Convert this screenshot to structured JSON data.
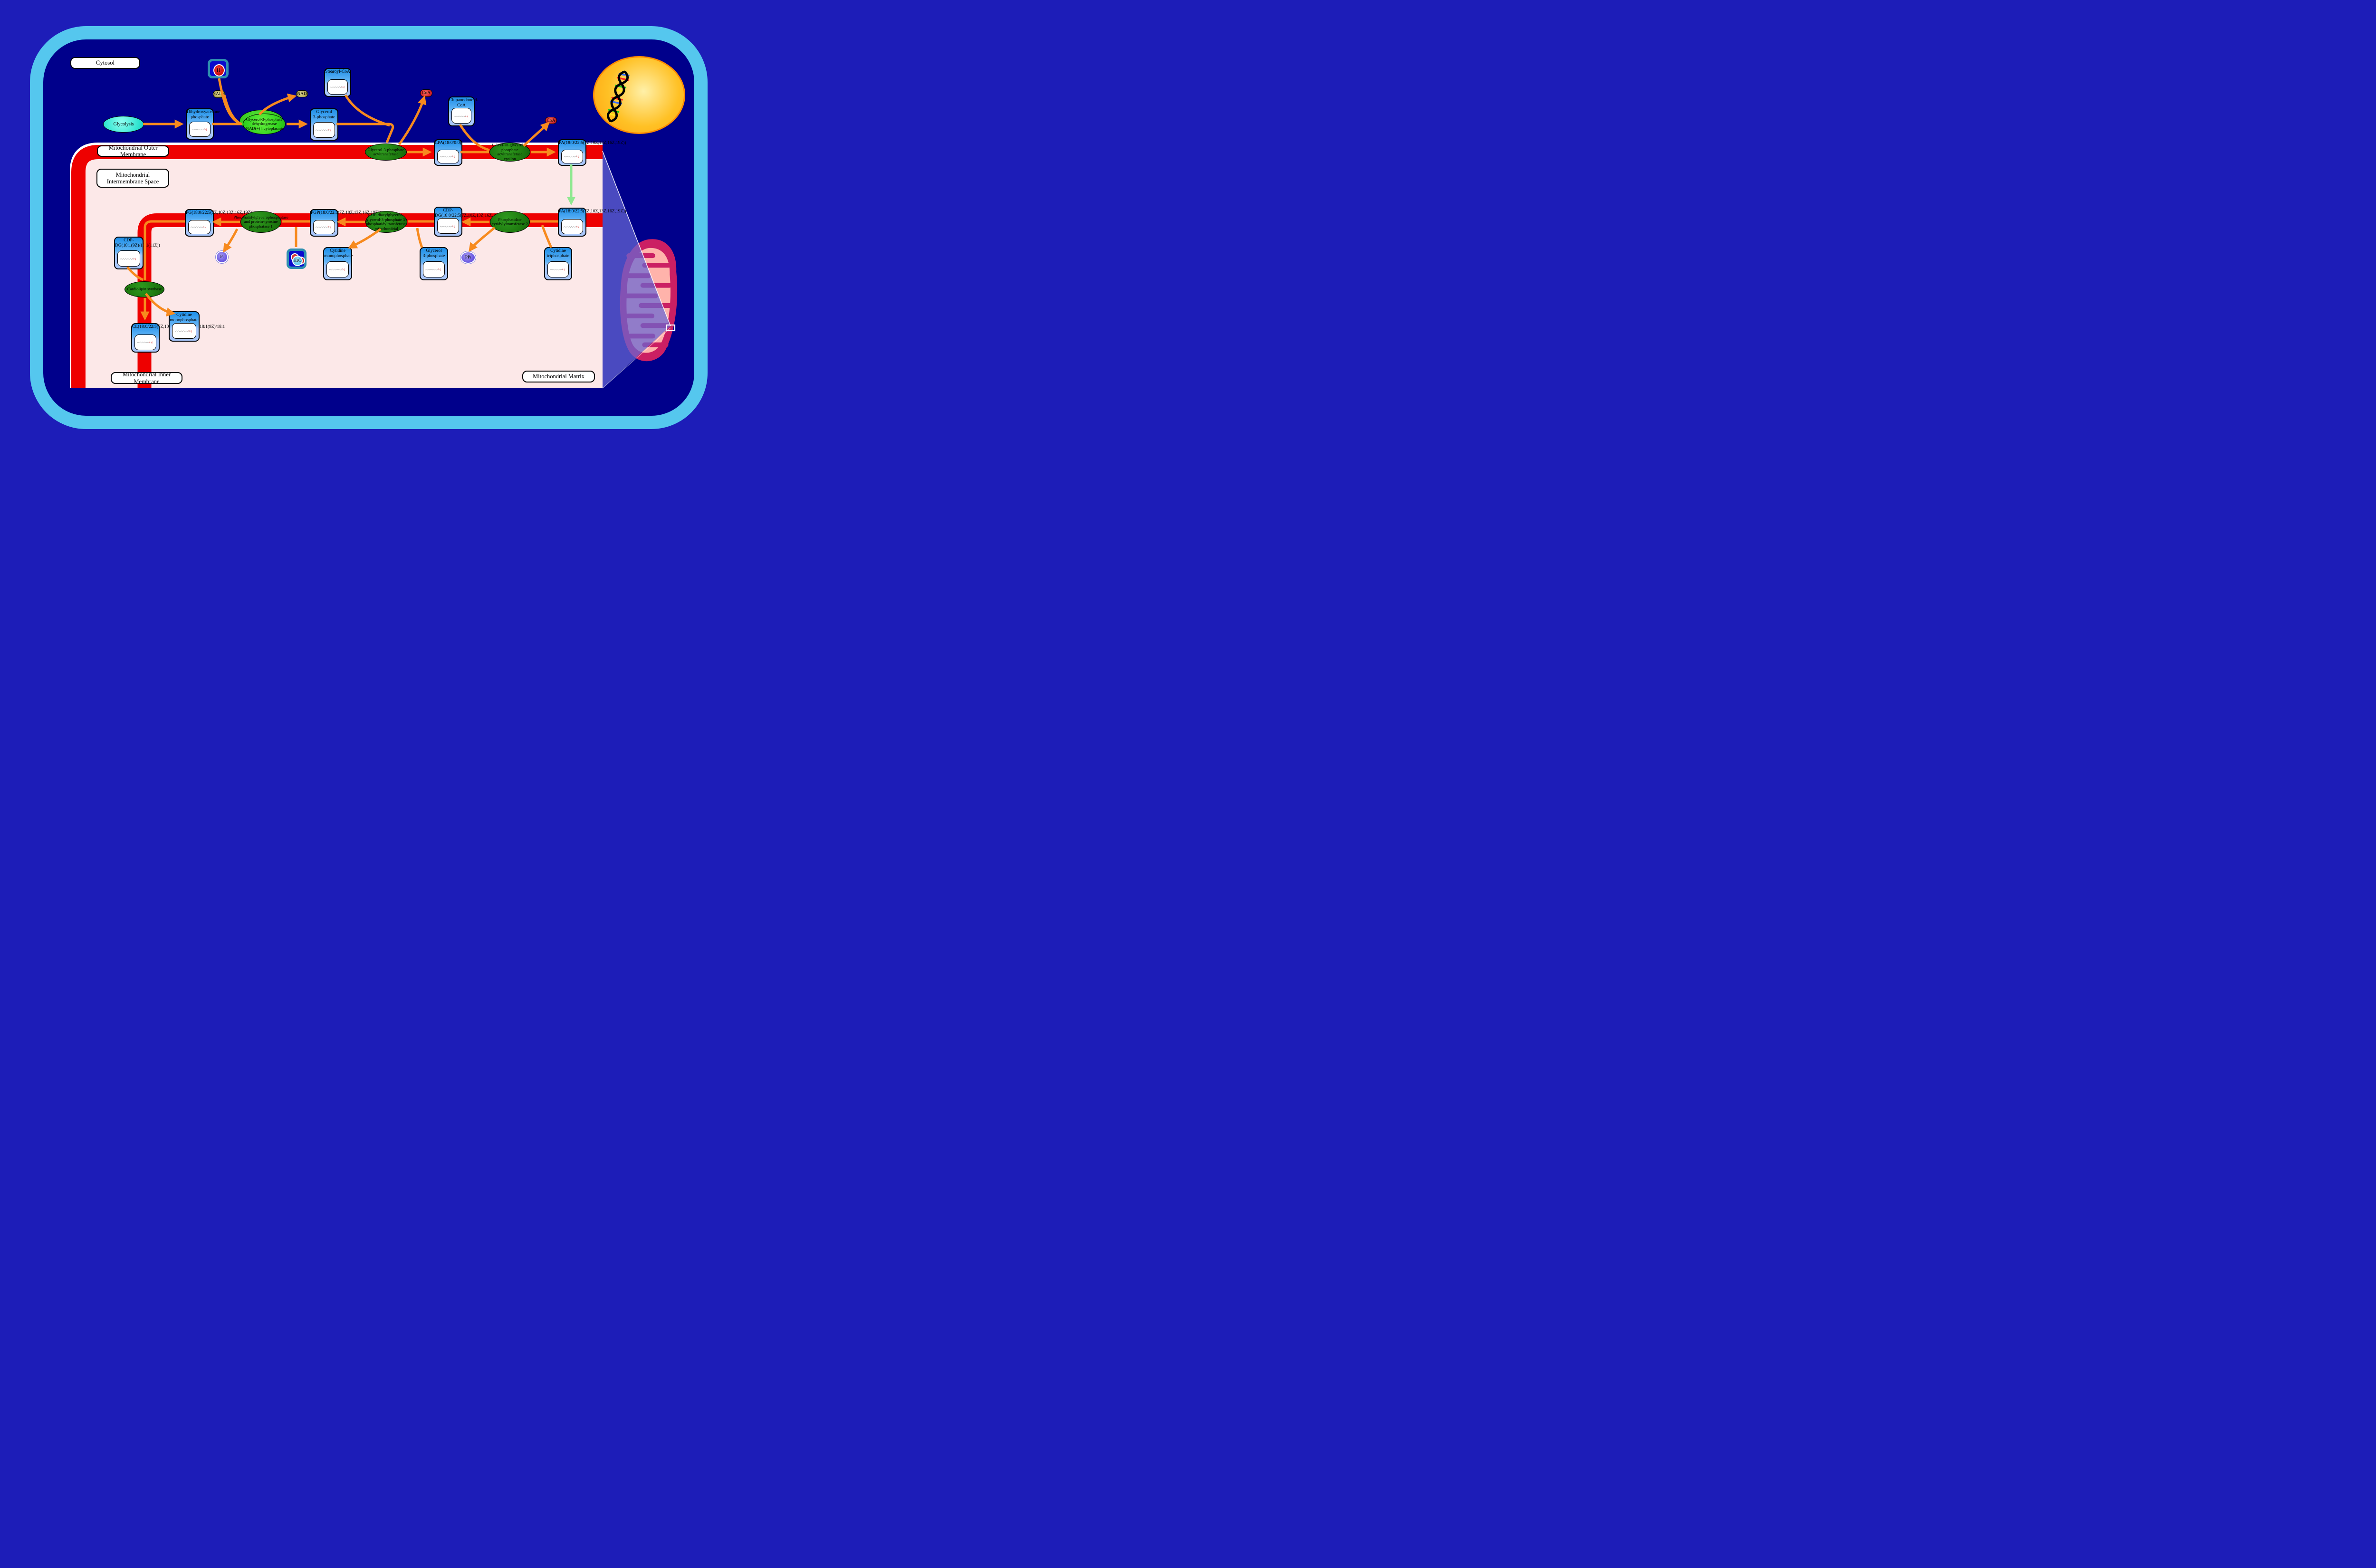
{
  "title": "Cardiolipin biosynthesis pathway diagram",
  "colors": {
    "page_background": "#1d1db8",
    "cell_fill": "#00008B",
    "cell_border": "#55C7EE",
    "membrane_red": "#EE0000",
    "compartment_pink": "#FCE8E8",
    "reaction_arrow_orange": "#F78A1E",
    "transport_arrow_green": "#8FE890",
    "enzyme_green_dark": "#1F7D10",
    "enzyme_green_bright": "#33D31F",
    "metabolite_box_blue": "#1E8FE8",
    "nucleus_yellow": "#FFC125",
    "mitochondrion_crimson": "#CB1F63",
    "mitochondrion_matrix_pink": "#FFB3AB",
    "projection_wedge": "rgba(102,102,212,0.72)"
  },
  "compartments": {
    "cytosol": {
      "label": "Cytosol"
    },
    "omm": {
      "label": "Mitochondrial Outer Membrane"
    },
    "ims": {
      "label": "Mitochondrial Intermembrane Space"
    },
    "imm": {
      "label": "Mitochondrial Inner Membrane"
    },
    "matrix": {
      "label": "Mitochondrial Matrix"
    }
  },
  "pathway_nodes": [
    {
      "id": "glycolysis",
      "label": "Glycolysis"
    }
  ],
  "metabolites": [
    {
      "id": "dhap",
      "lines": [
        "Dihydroxyacetone",
        "phosphate"
      ]
    },
    {
      "id": "stearoyl",
      "lines": [
        "Stearoyl-CoA"
      ]
    },
    {
      "id": "g3p_cyt",
      "lines": [
        "Glycerol",
        "3-phosphate"
      ]
    },
    {
      "id": "lpa",
      "lines": [
        "LPA(18:0/0:0)"
      ]
    },
    {
      "id": "clupanodonoyl",
      "lines": [
        "Clupanodonoyl-",
        "CoA"
      ]
    },
    {
      "id": "pa_om",
      "lines": [
        "PA(18:0/22:5(7Z,10Z,13Z,16Z,19Z))"
      ]
    },
    {
      "id": "pa_im",
      "lines": [
        "PA(18:0/22:5(7Z,10Z,13Z,16Z,19Z))"
      ]
    },
    {
      "id": "cdp_dg_im",
      "lines": [
        "CDP-",
        "DG(18:0/22:5(7Z,10Z,13Z,16Z,19Z))"
      ]
    },
    {
      "id": "pgp",
      "lines": [
        "PGP(18:0/22:5(7Z,10Z,13Z,16Z,19Z))"
      ]
    },
    {
      "id": "pg",
      "lines": [
        "PG(18:0/22:5(7Z,10Z,13Z,16Z,19Z))"
      ]
    },
    {
      "id": "ctp",
      "lines": [
        "Cytidine",
        "triphosphate"
      ]
    },
    {
      "id": "g3p_mx",
      "lines": [
        "Glycerol",
        "3-phosphate"
      ]
    },
    {
      "id": "cmp_mid",
      "lines": [
        "Cytidine",
        "monophosphate"
      ]
    },
    {
      "id": "cdp_dg_18_1",
      "lines": [
        "CDP-",
        "DG(18:1(9Z)/18:1(11Z))"
      ]
    },
    {
      "id": "cl",
      "lines": [
        "CL(18:0/22:5(7Z,10Z,13Z,16Z,19Z)/18:1(9Z)/18:1"
      ]
    },
    {
      "id": "cmp_bot",
      "lines": [
        "Cytidine",
        "monophosphate"
      ]
    }
  ],
  "enzymes": [
    {
      "id": "gpd1",
      "variant": "bright",
      "stacked": true,
      "label": "Glycerol-3-phosphate dehydrogenase [NAD(+)], cytoplasmic"
    },
    {
      "id": "gpat",
      "variant": "dark",
      "stacked": false,
      "label": "Glycerol-3-phosphate acyltransferase"
    },
    {
      "id": "agpat",
      "variant": "dark",
      "stacked": false,
      "label": "1-Acyl-sn-glycerol-3-phosphate acyltransferase epsilon"
    },
    {
      "id": "cds2",
      "variant": "dark",
      "stacked": false,
      "label": "Phosphatidate cytidylyltransferase 2"
    },
    {
      "id": "pgs1",
      "variant": "dark",
      "stacked": false,
      "label": "CDP-diacylglycerol--glycerol-3-phosphate 3-phosphatidyltransferase, mitochondrial"
    },
    {
      "id": "ptpmt1",
      "variant": "dark",
      "stacked": false,
      "label": "Phosphatidylglycerophosphatase and protein-tyrosine phosphatase 1"
    },
    {
      "id": "crls1",
      "variant": "dark",
      "stacked": false,
      "label": "Cardiolipin synthase"
    }
  ],
  "small_molecules": [
    {
      "id": "h_plus",
      "label": "H+",
      "kind": "boxed-ion"
    },
    {
      "id": "nadh",
      "label": "NADH",
      "kind": "olive-pill"
    },
    {
      "id": "nad",
      "label": "NAD",
      "kind": "olive-pill"
    },
    {
      "id": "coa1",
      "label": "CoA",
      "kind": "red-pill"
    },
    {
      "id": "coa2",
      "label": "CoA",
      "kind": "red-pill"
    },
    {
      "id": "h2o",
      "label": "H2O",
      "kind": "boxed-water"
    },
    {
      "id": "pi",
      "label": "Pi",
      "kind": "purple-circle"
    },
    {
      "id": "ppi",
      "label": "PPi",
      "kind": "purple-circle"
    }
  ]
}
